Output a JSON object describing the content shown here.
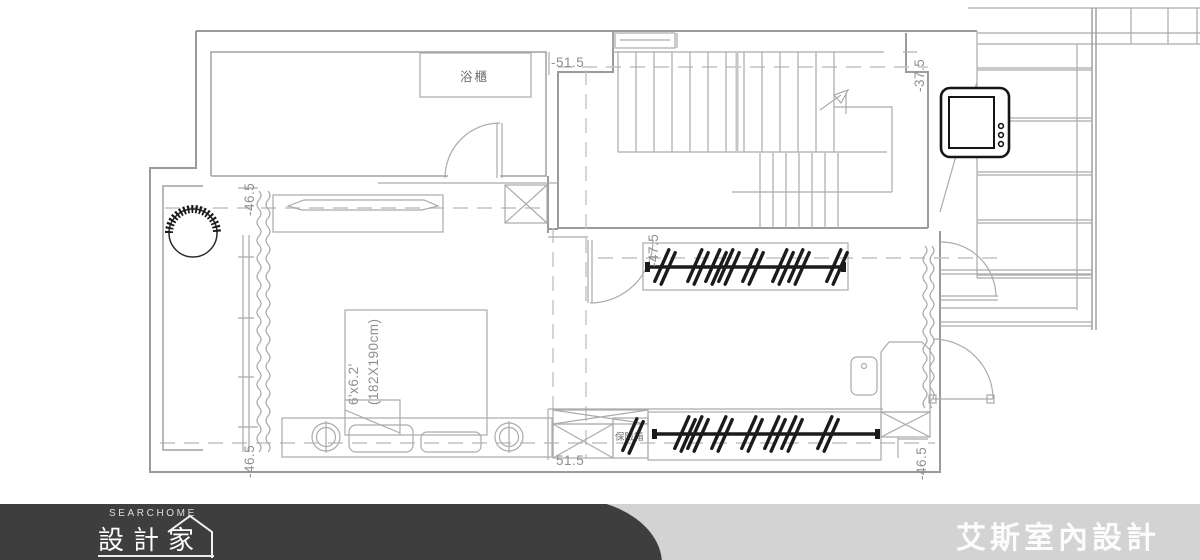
{
  "plan": {
    "rooms": {
      "bath_cabinet": "浴櫃",
      "safe": "保險箱"
    },
    "bed": {
      "size_imperial": "6'x6.2'",
      "size_metric": "(182X190cm)"
    },
    "dims": {
      "top_left": "-51.5",
      "top_right": "-37.5",
      "left_upper": "-46.5",
      "left_lower": "-46.5",
      "closet_top": "-47.5",
      "bottom_center": "51.5",
      "right_lower": "-46.5"
    },
    "colors": {
      "wall_line": "#9b9b9b",
      "dark_line": "#1b1b1b",
      "dashed_line": "#c3c3c3",
      "dim_text": "#8f8f8f"
    }
  },
  "footer": {
    "brand_small": "SEARCHOME",
    "brand_main": "設計家",
    "company": "艾斯室內設計",
    "colors": {
      "pill": "#3e3e3e",
      "bar": "#d3d3d3"
    }
  }
}
